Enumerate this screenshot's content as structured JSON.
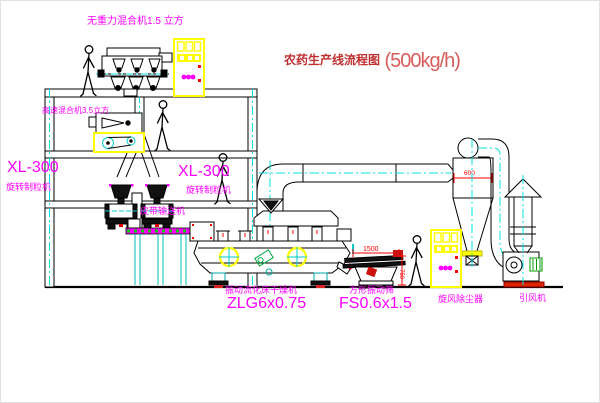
{
  "title": {
    "text": "农药生产线流程图",
    "capacity": "(500kg/h)"
  },
  "equipment": {
    "gravity_mixer": {
      "label": "无重力混合机1.5 立方"
    },
    "high_speed_mixer": {
      "label": "高速混合机3.5立方"
    },
    "granulator_left": {
      "model": "XL-300",
      "name": "旋转制粒机"
    },
    "granulator_right": {
      "model": "XL-300",
      "name": "旋转制粒机"
    },
    "belt_conveyor": {
      "label": "皮带输送机"
    },
    "dryer": {
      "name": "振动流化床干燥机",
      "model": "ZLG6x0.75"
    },
    "sieve": {
      "name": "方形振动筛",
      "model": "FS0.6x1.5",
      "dim_width": "1500",
      "dim_height": "750"
    },
    "cyclone": {
      "label": "旋风除尘器",
      "dim_width": "600"
    },
    "fan": {
      "label": "引风机"
    }
  },
  "colors": {
    "label_magenta": "#ff00ff",
    "title_red": "#c03030",
    "dimension_red": "#ff0000",
    "cabinet_yellow": "#ffff00",
    "centerline_cyan": "#00e0e0",
    "conveyor_green": "#00d000"
  }
}
